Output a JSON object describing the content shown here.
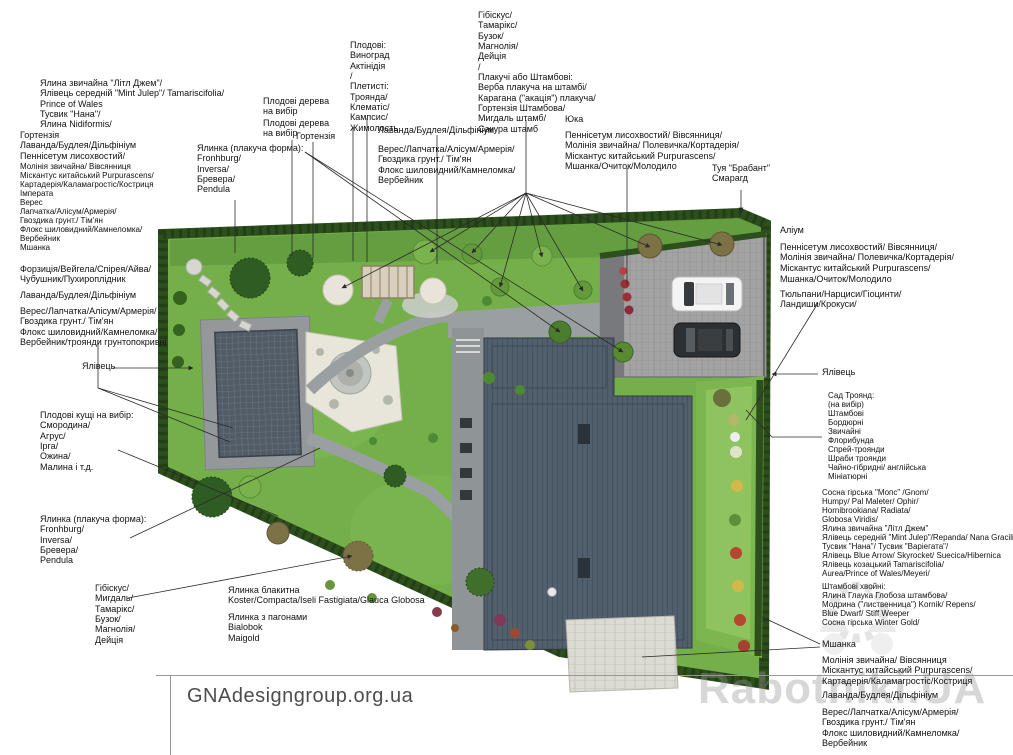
{
  "footer": {
    "site": "GNAdesigngroup.org.ua"
  },
  "watermark": {
    "text": "Rabotniki.UA"
  },
  "colors": {
    "lawn": "#74af4a",
    "lawn_dark": "#619b3e",
    "hedge": "#2d4f1d",
    "roof": "#525f6d",
    "pavement": "#9aa0a2",
    "parking": "#a3a3a3",
    "stone": "#e8e6db",
    "grid_court": "#515c66",
    "accent_red": "#b8452f"
  },
  "labels": [
    {
      "id": "conifers-topleft",
      "text": "Ялина звичайна \"Літл Джем\"/\nЯлівець середній \"Mint Julep\"/ Tamariscifolia/\nPrince of Wales\nТусвик \"Нана\"/\nЯлина Nidiformis/"
    },
    {
      "id": "hortensia-lavender-left",
      "text": "Гортензія\nЛаванда/Будлея/Дільфініум\nПеннісетум лисохвостий/"
    },
    {
      "id": "grasses-left",
      "text": "Молінія звичайна/ Вівсянниця\nМіскантус китайський Purpurascens/\nКартадерія/Каламагростіс/Костриця\nІмперата\nВерес\nЛапчатка/Алісум/Армерія/\nГвоздика грунт./ Тім'ян\nФлокс шиловидний/Камнеломка/\nВербейник\nМшанка"
    },
    {
      "id": "shrubs-forzicia",
      "text": "Форзиція/Вейгела/Спірея/Айва/\nЧубушник/Пухироплідник"
    },
    {
      "id": "lavender-left",
      "text": "Лаванда/Будлея/Дільфініум"
    },
    {
      "id": "heather-left",
      "text": "Верес/Лапчатка/Алісум/Армерія/\nГвоздика грунт./ Тім'ян\nФлокс шиловидний/Камнеломка/\nВербейник/троянди грунтопокривні"
    },
    {
      "id": "juniper-left",
      "text": "Ялівець"
    },
    {
      "id": "fruit-bushes",
      "text": "Плодові кущі на вибір:\nСмородина/\nАгрус/\nІрга/\nОжина/\nМалина і т.д."
    },
    {
      "id": "weeping-spruce-left",
      "text": "Ялинка (плакуча форма):\nFronhburg/\nInversa/\nБревера/\nPendula"
    },
    {
      "id": "hibiscus-bottom",
      "text": "Гібіскус/\nМигдаль/\nТамарікс/\nБузок/\nМагнолія/\nДейція"
    },
    {
      "id": "blue-spruce",
      "text": "Ялинка блакитна\nKoster/Compacta/Iseli Fastigiata/Glauca Globosa"
    },
    {
      "id": "spruce-bialobok",
      "text": "Ялинка з пагонами\nBialobok\nMaigold"
    },
    {
      "id": "weeping-spruce-mid",
      "text": "Ялинка (плакуча форма):\nFronhburg/\nInversa/\nБревера/\nPendula"
    },
    {
      "id": "fruit-trees-1",
      "text": "Плодові дерева\nна вибір"
    },
    {
      "id": "fruit-trees-2",
      "text": "Плодові дерева\nна вибір"
    },
    {
      "id": "hortensia-mid",
      "text": "Гортензія"
    },
    {
      "id": "climbers-top",
      "text": "Плодові:\nВиноград\nАктінідія\n/\nПлетисті:\nТроянда/\nКлематіс/\nКампсис/\nЖимолость"
    },
    {
      "id": "lavender-mid",
      "text": "Лаванда/Будлея/Дільфініум"
    },
    {
      "id": "heather-mid",
      "text": "Верес/Лапчатка/Алісум/Армерія/\nГвоздика грунт./ Тім'ян\nФлокс шиловидний/Камнеломка/\nВербейник"
    },
    {
      "id": "standard-trees-top",
      "text": "Гібіскус/\nТамарікс/\nБузок/\nМагнолія/\nДейція\n/\nПлакучі або Штамбові:\nВерба плакуча на штамбі/\nКарагана (\"акація\") плакуча/\nГортензія Штамбова/\nМигдаль штамб/\nСакура штамб"
    },
    {
      "id": "yucca",
      "text": "Юка"
    },
    {
      "id": "grasses-center",
      "text": "Пеннісетум лисохвостий/ Вівсянниця/\nМолінія звичайна/ Полевичка/Кортадерія/\nМіскантус китайський Purpurascens/"
    },
    {
      "id": "moss-center",
      "text": "Мшанка/Очиток/Молодило"
    },
    {
      "id": "thuja",
      "text": "Туя \"Брабант\"\nСмарагд"
    },
    {
      "id": "allium",
      "text": "Аліум"
    },
    {
      "id": "grasses-right",
      "text": "Пеннісетум лисохвостий/ Вівсянниця/\nМолінія звичайна/ Полевичка/Кортадерія/\nМіскантус китайський Purpurascens/"
    },
    {
      "id": "moss-right",
      "text": "Мшанка/Очиток/Молодило"
    },
    {
      "id": "bulbs-right",
      "text": "Тюльпани/Нарциси/Гіоцинти/\nЛандиши/Крокуси/"
    },
    {
      "id": "juniper-right",
      "text": "Ялівець"
    },
    {
      "id": "rose-garden",
      "text": "Сад Троянд:\n(на вибір)\nШтамбові\nБордюрні\nЗвичайні\nФлорибунда\nСпрей-троянди\nШраби троянди\nЧайно-гібридні/ англійська\nМініатюрні"
    },
    {
      "id": "conifers-right",
      "text": "Сосна гірська \"Мопс\" /Gnom/\nHumpy/ Pal Maleter/ Ophir/\nHornibrookiana/ Radiata/\nGlobosa Viridis/\nЯлина звичайна \"Літл Джем\"\nЯлівець середній \"Mint Julep\"/Repanda/ Nana Gracilis\nТусвик \"Нана\"/ Тусвик \"Варіегата\"/\nЯлівець Blue Arrow/ Skyrocket/ Suecica/Hibernica\nЯлівець козацький Tamariscifolia/\nAurea/Prince of Wales/Meyeri/"
    },
    {
      "id": "standard-conifers",
      "text": "Штамбові хвойні:\nЯлина Глаука Глобоза штамбова/\nМодрина (\"лиственница\") Kornik/ Repens/\nBlue Dwarf/ Stiff Weeper\nСосна гірська Winter Gold/"
    },
    {
      "id": "moss-bottomright",
      "text": "Мшанка"
    },
    {
      "id": "grasses-bottomright",
      "text": "Молінія звичайна/ Вівсянниця\nМіскантус китайський Purpurascens/\nКартадерія/Каламагростіс/Костриця"
    },
    {
      "id": "lavender-bottomright",
      "text": "Лаванда/Будлея/Дільфініум"
    },
    {
      "id": "heather-bottomright",
      "text": "Верес/Лапчатка/Алісум/Армерія/\nГвоздика грунт./ Тім'ян\nФлокс шиловидний/Камнеломка/\nВербейник"
    }
  ]
}
